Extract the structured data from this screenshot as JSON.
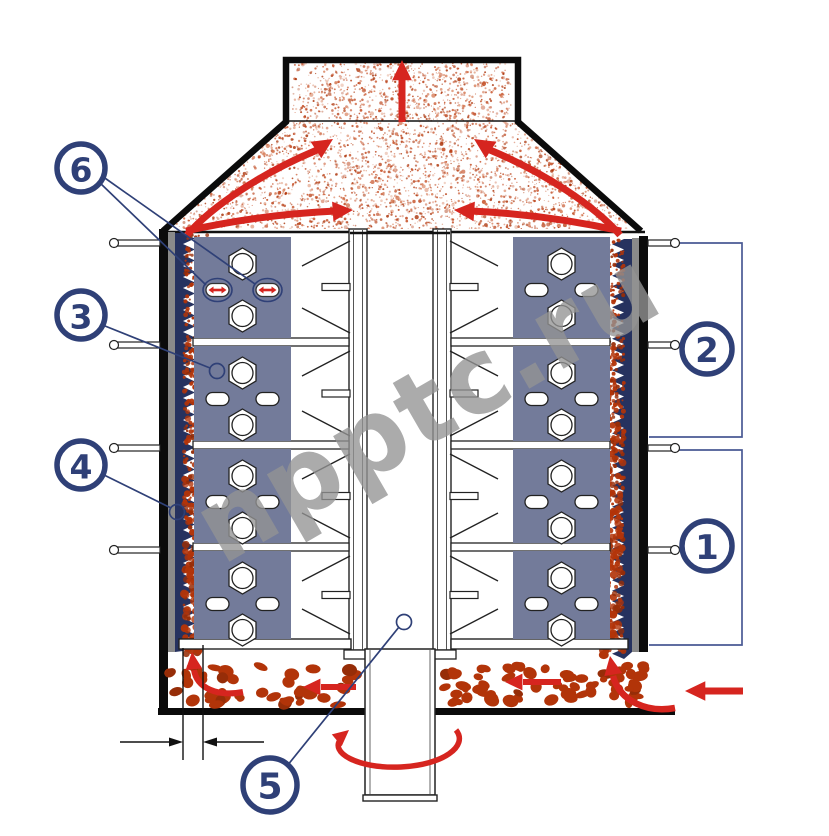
{
  "diagram": {
    "type": "vertical-mill-dryer-cross-section",
    "watermark": "npptc.ru",
    "callouts": {
      "c1": "1",
      "c2": "2",
      "c3": "3",
      "c4": "4",
      "c5": "5",
      "c6": "6"
    }
  },
  "colors": {
    "outline": "#0b0b0b",
    "machine_line": "#222222",
    "wall_gray": "#8a8a8a",
    "liner_navy": "#26325f",
    "panel_slate": "#737b9a",
    "particle_red": "#b23409",
    "particle_dark": "#962d08",
    "speckle": "#c4491e",
    "arrow_red": "#d6251f",
    "annotation_navy": "#2f4077",
    "bracket_blue": "#4a5a94",
    "watermark_gray": "#949494"
  }
}
